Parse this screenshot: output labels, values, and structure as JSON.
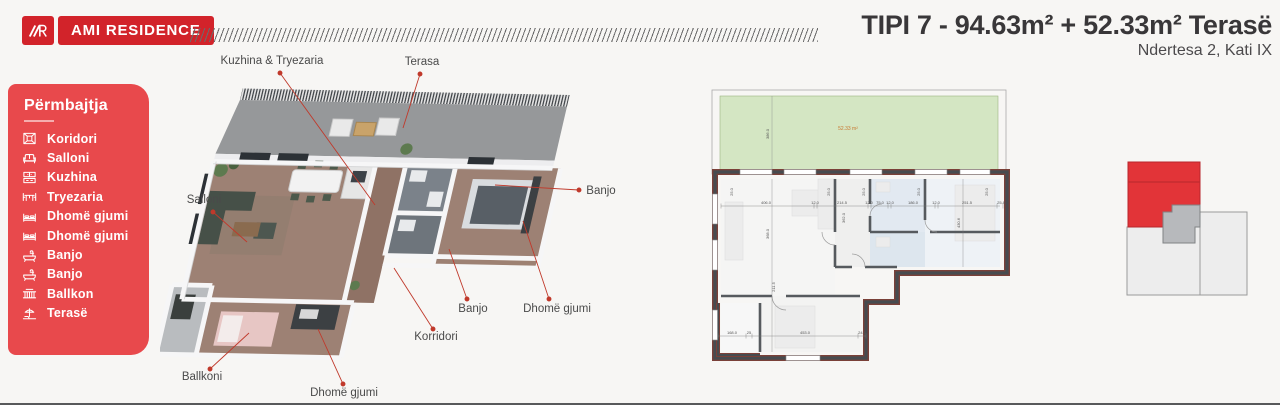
{
  "header": {
    "logo": {
      "monogram": "AR",
      "brand": "AMI RESIDENCE"
    },
    "title": "TIPI 7 - 94.63m² + 52.33m² Terasë",
    "subtitle": "Ndertesa 2, Kati IX"
  },
  "sidebar": {
    "title": "Përmbajtja",
    "items": [
      {
        "icon": "corridor-icon",
        "label": "Koridori"
      },
      {
        "icon": "sofa-icon",
        "label": "Salloni"
      },
      {
        "icon": "kitchen-icon",
        "label": "Kuzhina"
      },
      {
        "icon": "dining-table-icon",
        "label": "Tryezaria"
      },
      {
        "icon": "bed-icon",
        "label": "Dhomë gjumi"
      },
      {
        "icon": "bed-icon",
        "label": "Dhomë gjumi"
      },
      {
        "icon": "bathtub-icon",
        "label": "Banjo"
      },
      {
        "icon": "bathtub-icon",
        "label": "Banjo"
      },
      {
        "icon": "balcony-icon",
        "label": "Ballkon"
      },
      {
        "icon": "terrace-icon",
        "label": "Terasë"
      }
    ]
  },
  "plan3d": {
    "labels": [
      {
        "text": "Kuzhina & Tryezaria"
      },
      {
        "text": "Terasa"
      },
      {
        "text": "Salloni"
      },
      {
        "text": "Banjo"
      },
      {
        "text": "Banjo"
      },
      {
        "text": "Dhomë gjumi"
      },
      {
        "text": "Korridori"
      },
      {
        "text": "Ballkoni"
      },
      {
        "text": "Dhomë gjumi"
      }
    ]
  },
  "plan2d": {
    "terrace_area": "52.33 m²",
    "dims_top": [
      "406.0",
      "12.0",
      "214.5",
      "12.0",
      "75.0",
      "12.0",
      "186.0",
      "12.0",
      "251.5",
      "25.8"
    ],
    "dims_bottom": [
      "168.0",
      "25",
      "453.0",
      "24.5"
    ],
    "dims_vertical": [
      "386.0",
      "368.0",
      "362.0",
      "211.5",
      "430.6"
    ],
    "wall_dims": [
      "25.0",
      "25.0",
      "25.0",
      "25.0",
      "25.0"
    ]
  },
  "colors": {
    "brand_red": "#d2232a",
    "sidebar_red": "#e8494c",
    "terrace_green": "#d4e6c3",
    "accent_orange": "#c87830",
    "leader_red": "#c0392b"
  }
}
